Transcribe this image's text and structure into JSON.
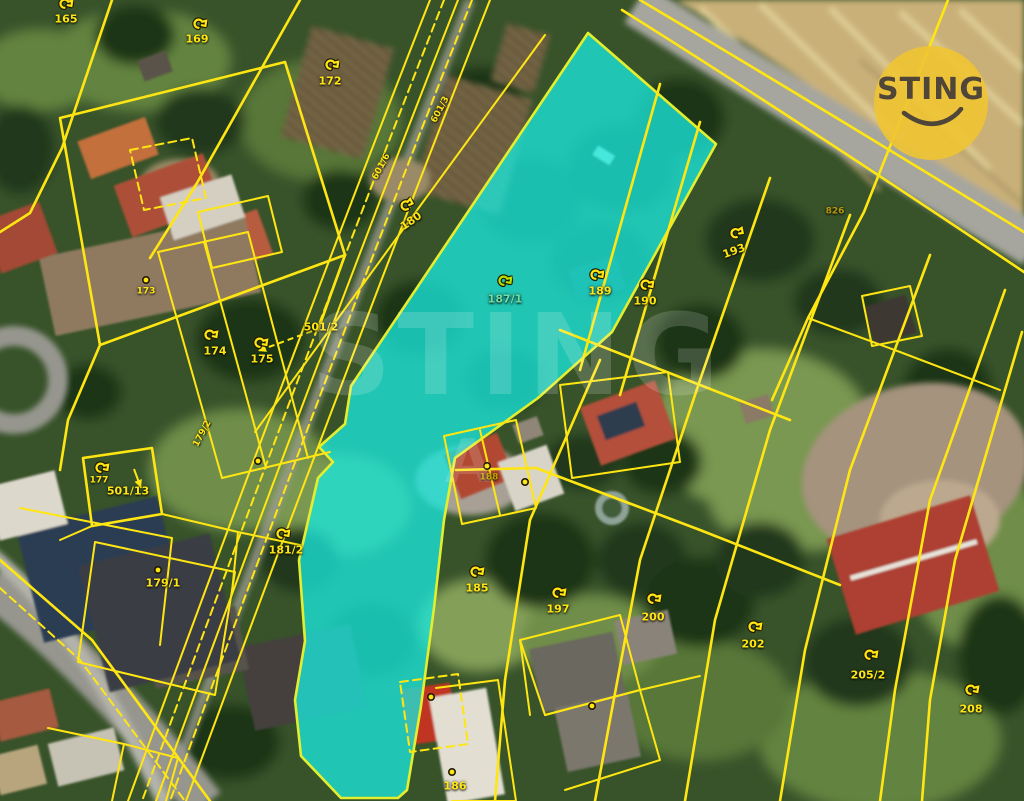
{
  "meta": {
    "width": 1024,
    "height": 801,
    "description_domain": "cadastral-aerial-map"
  },
  "branding": {
    "logo_text": "STING",
    "logo_bg": "#f0c432",
    "logo_text_color": "#4f4639",
    "watermark_text": "STING",
    "watermark_secondary": "A"
  },
  "map": {
    "highlight_color": "#19e5da",
    "boundary_color": "#ffe613",
    "highlighted_parcel": "187/1",
    "parcel_labels": [
      {
        "text": "165",
        "x": 66,
        "y": 19,
        "rot": 0,
        "size": "normal",
        "icon": {
          "type": "flag",
          "x": 66,
          "y": 4
        }
      },
      {
        "text": "169",
        "x": 197,
        "y": 39,
        "rot": 0,
        "size": "normal",
        "icon": {
          "type": "flag",
          "x": 200,
          "y": 24
        }
      },
      {
        "text": "172",
        "x": 330,
        "y": 81,
        "rot": 0,
        "size": "normal",
        "icon": {
          "type": "flag",
          "x": 332,
          "y": 65
        }
      },
      {
        "text": "180",
        "x": 411,
        "y": 221,
        "rot": -35,
        "size": "normal",
        "icon": {
          "type": "flag",
          "x": 407,
          "y": 205
        }
      },
      {
        "text": "601/6",
        "x": 382,
        "y": 167,
        "rot": -62,
        "size": "small"
      },
      {
        "text": "601/3",
        "x": 441,
        "y": 110,
        "rot": -62,
        "size": "small"
      },
      {
        "text": "173",
        "x": 146,
        "y": 292,
        "rot": 0,
        "size": "small",
        "icon": {
          "type": "dot",
          "x": 146,
          "y": 280
        }
      },
      {
        "text": "174",
        "x": 215,
        "y": 351,
        "rot": 0,
        "size": "normal",
        "icon": {
          "type": "flag",
          "x": 211,
          "y": 335
        }
      },
      {
        "text": "175",
        "x": 262,
        "y": 359,
        "rot": 0,
        "size": "normal",
        "icon": {
          "type": "flag",
          "x": 261,
          "y": 343
        }
      },
      {
        "text": "501/2",
        "x": 321,
        "y": 327,
        "rot": 0,
        "size": "normal"
      },
      {
        "text": "177",
        "x": 99,
        "y": 481,
        "rot": 0,
        "size": "small"
      },
      {
        "text": "501/13",
        "x": 128,
        "y": 491,
        "rot": 0,
        "size": "normal",
        "icon": {
          "type": "flag",
          "x": 102,
          "y": 468
        }
      },
      {
        "text": "179/2",
        "x": 203,
        "y": 434,
        "rot": -62,
        "size": "small"
      },
      {
        "text": "179/1",
        "x": 163,
        "y": 583,
        "rot": 0,
        "size": "normal",
        "icon": {
          "type": "dot",
          "x": 158,
          "y": 570
        }
      },
      {
        "text": "181/2",
        "x": 286,
        "y": 550,
        "rot": 0,
        "size": "normal",
        "icon": {
          "type": "flag",
          "x": 283,
          "y": 534
        }
      },
      {
        "text": "185",
        "x": 477,
        "y": 588,
        "rot": 0,
        "size": "normal",
        "icon": {
          "type": "flag",
          "x": 477,
          "y": 572
        }
      },
      {
        "text": "187/1",
        "x": 505,
        "y": 299,
        "rot": 0,
        "size": "normal",
        "color": "#6fdfa6",
        "icon": {
          "type": "flag",
          "x": 505,
          "y": 281,
          "color": "#b5e000"
        }
      },
      {
        "text": "189",
        "x": 600,
        "y": 291,
        "rot": 0,
        "size": "normal",
        "icon": {
          "type": "flag",
          "x": 597,
          "y": 275
        }
      },
      {
        "text": "190",
        "x": 645,
        "y": 301,
        "rot": 0,
        "size": "normal",
        "icon": {
          "type": "flag",
          "x": 647,
          "y": 285
        }
      },
      {
        "text": "193",
        "x": 734,
        "y": 251,
        "rot": -20,
        "size": "normal",
        "icon": {
          "type": "flag",
          "x": 737,
          "y": 233
        }
      },
      {
        "text": "197",
        "x": 558,
        "y": 609,
        "rot": 0,
        "size": "normal",
        "icon": {
          "type": "flag",
          "x": 559,
          "y": 593
        }
      },
      {
        "text": "200",
        "x": 653,
        "y": 617,
        "rot": 0,
        "size": "normal",
        "icon": {
          "type": "flag",
          "x": 654,
          "y": 599
        }
      },
      {
        "text": "202",
        "x": 753,
        "y": 644,
        "rot": 0,
        "size": "normal",
        "icon": {
          "type": "flag",
          "x": 755,
          "y": 627
        }
      },
      {
        "text": "205/2",
        "x": 868,
        "y": 675,
        "rot": 0,
        "size": "normal",
        "icon": {
          "type": "flag",
          "x": 871,
          "y": 655
        }
      },
      {
        "text": "208",
        "x": 971,
        "y": 709,
        "rot": 0,
        "size": "normal",
        "icon": {
          "type": "flag",
          "x": 972,
          "y": 690
        }
      },
      {
        "text": "186",
        "x": 455,
        "y": 786,
        "rot": 0,
        "size": "normal",
        "icon": {
          "type": "dot",
          "x": 452,
          "y": 772
        }
      },
      {
        "text": "188",
        "x": 489,
        "y": 478,
        "rot": 0,
        "size": "small",
        "color": "#c7a400",
        "icon": {
          "type": "dot",
          "x": 487,
          "y": 466
        }
      },
      {
        "text": "826",
        "x": 835,
        "y": 212,
        "rot": 0,
        "size": "small",
        "color": "#b89a10"
      }
    ],
    "building_markers": [
      {
        "x": 525,
        "y": 482
      },
      {
        "x": 431,
        "y": 697
      },
      {
        "x": 592,
        "y": 706
      },
      {
        "x": 258,
        "y": 461
      }
    ],
    "arrows": [
      {
        "x1": 312,
        "y1": 331,
        "x2": 258,
        "y2": 351,
        "dashed": true
      },
      {
        "x1": 134,
        "y1": 469,
        "x2": 141,
        "y2": 488,
        "dashed": false
      }
    ]
  }
}
